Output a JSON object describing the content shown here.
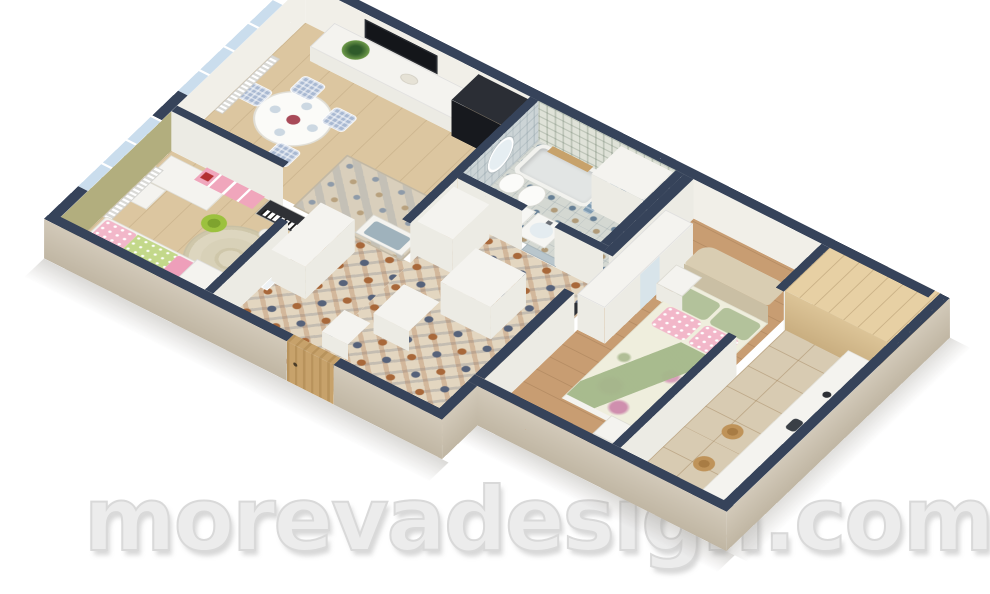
{
  "watermark": {
    "text": "morevadesign.com"
  },
  "palette": {
    "wall_top_navy": "#36435a",
    "wall_face_beige": "#d2c9b9",
    "wall_face_beige_dark": "#c0b6a3",
    "floor_wood_light": "#dcc6a0",
    "floor_wood_warm": "#c89d72",
    "kitchen_tile": "#d8cbb2",
    "hall_tile_base": "#e3d6c0",
    "hall_tile_terracotta": "#a8683a",
    "hall_tile_blue": "#56627a",
    "bath_tile_base": "#d4d8d2",
    "bath_tile_blue": "#667f95",
    "glass_blue": "#cadded",
    "olive_wall": "#b2ae7e",
    "white_furniture": "#f4f3ef",
    "pink": "#f0a6bc",
    "green_chair": "#9cc13e",
    "mattress_green": "#c3d88a",
    "sage_green": "#b3c29b",
    "cream": "#efeedd",
    "rose": "#cf8fae",
    "gingham_blue": "#a9b9d2",
    "curtain_blue": "#7e9bb2",
    "appliance_dark": "#1d2025",
    "wood_door": "#c7a26b",
    "wood_panel": "#e7d0a4",
    "stool_wood": "#bf9359",
    "watermark_gray": "#ececec"
  }
}
